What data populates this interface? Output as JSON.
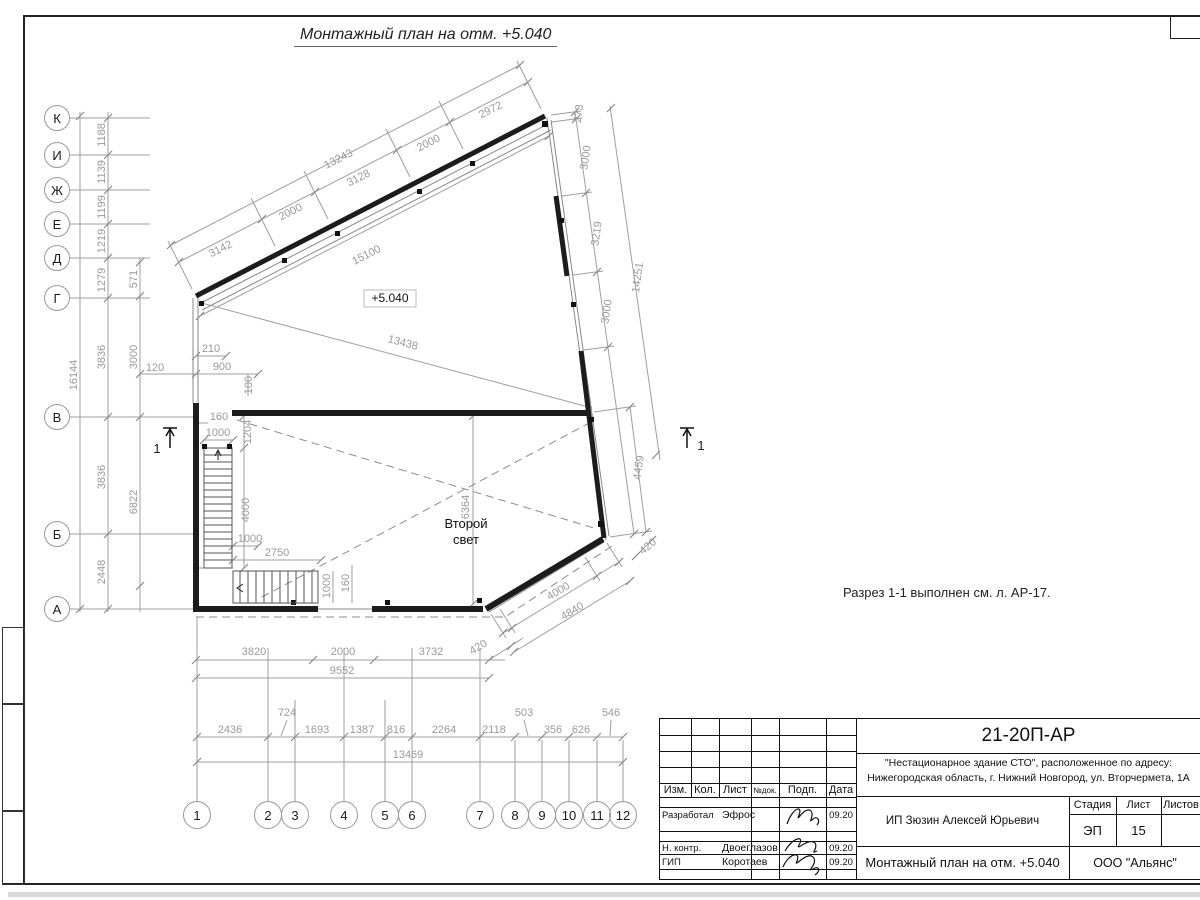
{
  "sheet": {
    "title": "Монтажный план на отм. +5.040",
    "note": "Разрез 1-1 выполнен см. л. АР-17.",
    "level_mark": "+5.040",
    "room_label_line1": "Второй",
    "room_label_line2": "свет",
    "section_mark": "1"
  },
  "axes": {
    "rows": [
      "К",
      "И",
      "Ж",
      "Е",
      "Д",
      "Г",
      "В",
      "Б",
      "А"
    ],
    "cols": [
      "1",
      "2",
      "3",
      "4",
      "5",
      "6",
      "7",
      "8",
      "9",
      "10",
      "11",
      "12"
    ]
  },
  "dims": {
    "top": [
      "3142",
      "2000",
      "3128",
      "2000",
      "2972"
    ],
    "top_total": "13243",
    "diag1": "15100",
    "diag2": "13438",
    "r273": "273",
    "right": [
      "3000",
      "3219",
      "3000"
    ],
    "right_total": "14251",
    "r4459": "4459",
    "r420": "420",
    "ch4000": "4000",
    "ch4840": "4840",
    "b420": "420",
    "bottom": [
      "3820",
      "2000",
      "3732"
    ],
    "bottom_total": "9552",
    "axisch": [
      "2436",
      "724",
      "1693",
      "1387",
      "816",
      "2264",
      "2118",
      "503",
      "356",
      "626",
      "546"
    ],
    "axis_total": "13469",
    "left_total": "16144",
    "leftch": [
      "1188",
      "1139",
      "1199",
      "1219",
      "1279",
      "3836",
      "3836",
      "2448"
    ],
    "l571": "571",
    "l3000": "3000",
    "l6822": "6822",
    "l120": "120",
    "w210": "210",
    "w900": "900",
    "w100": "100",
    "w160a": "160",
    "w1000a": "1000",
    "w1204": "1204",
    "s4000": "4000",
    "s1000b": "1000",
    "s2750": "2750",
    "s6364": "6364",
    "s1000c": "1000",
    "s160b": "160"
  },
  "titleblock": {
    "doc_code": "21-20П-АР",
    "object_line1": "\"Нестационарное здание СТО\", расположенное по адресу:",
    "object_line2": "Нижегородская область, г. Нижний Новгород, ул. Вторчермета, 1А",
    "col_izm": "Изм.",
    "col_kol": "Кол.",
    "col_list": "Лист",
    "col_ndok": "№док.",
    "col_podp": "Подп.",
    "col_data": "Дата",
    "row1_role": "Разработал",
    "row1_name": "Эфрос",
    "row1_date": "09.20",
    "row2_role": "Н. контр.",
    "row2_name": "Двоеглазов",
    "row2_date": "09.20",
    "row3_role": "ГИП",
    "row3_name": "Коротаев",
    "row3_date": "09.20",
    "customer": "ИП Зюзин Алексей Юрьевич",
    "stage_label": "Стадия",
    "sheet_label": "Лист",
    "sheets_label": "Листов",
    "stage_value": "ЭП",
    "sheet_value": "15",
    "drawing_name": "Монтажный план на отм. +5.040",
    "company": "ООО \"Альянс\""
  }
}
